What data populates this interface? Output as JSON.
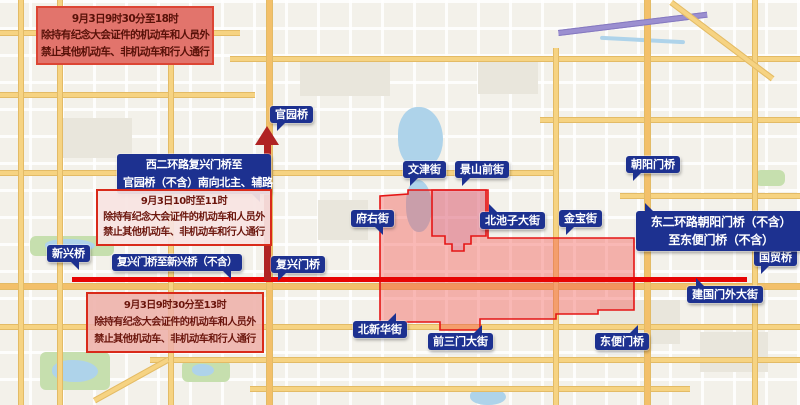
{
  "notices": {
    "full_day": {
      "time": "9月3日9时30分至18时",
      "rule1": "除持有纪念大会证件的机动车和人员外",
      "rule2": "禁止其他机动车、非机动车和行人通行"
    },
    "morning": {
      "time": "9月3日10时至11时",
      "rule1": "除持有纪念大会证件的机动车和人员外",
      "rule2": "禁止其他机动车、非机动车和行人通行"
    },
    "midday": {
      "time": "9月3日9时30分至13时",
      "rule1": "除持有纪念大会证件的机动车和人员外",
      "rule2": "禁止其他机动车、非机动车和行人通行"
    }
  },
  "route_callouts": {
    "west": {
      "line1": "西二环路复兴门桥至",
      "line2": "官园桥（不含）南向北主、辅路"
    },
    "east": {
      "line1": "东二环路朝阳门桥（不含）",
      "line2": "至东便门桥（不含）"
    },
    "central": "复兴门桥至新兴桥（不含）"
  },
  "map_labels": {
    "xinxingqiao": "新兴桥",
    "guanyuanqiao": "官园桥",
    "fuxingmenqiao": "复兴门桥",
    "wenjinjie": "文津街",
    "fuyoujie": "府右街",
    "jingshanqianjie": "景山前街",
    "beichizidajie": "北池子大街",
    "jinbaojie": "金宝街",
    "chaoyangmenqiao": "朝阳门桥",
    "guomaoqiao": "国贸桥",
    "jianguomenwaidajie": "建国门外大街",
    "dongbianmenqiao": "东便门桥",
    "beixinhuajie": "北新华街",
    "qiansanmendajie": "前三门大街"
  },
  "colors": {
    "restricted_line": "#e60404",
    "direction_arrow": "#b02323",
    "zone_fill": "#f04a46",
    "zone_border": "#e51515",
    "callout_bg": "#1d3190",
    "notice_border": "#d92a1a"
  }
}
